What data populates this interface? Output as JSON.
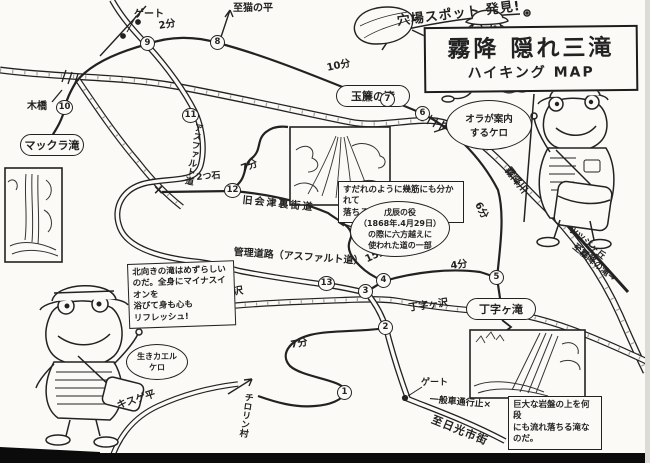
{
  "colors": {
    "ink": "#222222",
    "paper": "#fbfaf7",
    "bottom_bar": "#0b0b0b"
  },
  "title": {
    "banner": "穴場スポット 発見!",
    "main": "霧降 隠れ三滝",
    "sub": "ハイキング MAP"
  },
  "falls": {
    "makkura": "マックラ滝",
    "tamasudare": "玉簾の滝",
    "choji": "丁字ヶ滝"
  },
  "stations": [
    "1",
    "2",
    "3",
    "4",
    "5",
    "6",
    "7",
    "8",
    "9",
    "10",
    "11",
    "12",
    "13"
  ],
  "labels": {
    "gate_top": "ゲート",
    "min2_top": "2分",
    "to_nekonodaira": "至猫の平",
    "min10": "10分",
    "wood_bridge_left": "木橋",
    "wood_bridge_right": "木橋",
    "asphalt_road": "アスファルト道",
    "two_stones": "2つ石",
    "min7_upper": "7分",
    "old_aizu_road": "旧会津裏街道",
    "closed_x": "×",
    "kanri_road": "管理道路（アスファルト道）",
    "choji_sawa_left": "丁字ヶ沢",
    "choji_sawa_right": "丁字ヶ沢",
    "min15": "15分",
    "min4": "4分",
    "min6": "6分",
    "min7_lower": "7分",
    "kirifuri_river": "霧降川",
    "tsutsujigaoka": "ツツジヶ丘",
    "to_kirifuri_falls": "至霧降の滝→",
    "gate_bottom": "ゲート",
    "no_cars": "一般車通行止×",
    "to_nikko_city": "至日光市街",
    "kisuge_daira": "キスゲ平",
    "chirorin_mura": "チロリン村"
  },
  "notes": {
    "guide_bubble": "オラが案内\nするケロ",
    "boshin_note": "戊辰の役\n（1868年.4月29日）\nの際に六方越えに\n使われた道の一部",
    "tamasudare_caption": "すだれのように幾筋にも分かれて\n落ちる滝だ。",
    "choji_caption": "巨大な岩盤の上を何段\nにも流れ落ちる滝なのだ。",
    "makkura_sign": "北向きの滝はめずらしい\nのだ。全身にマイナスイオンを\n浴びて身も心も\nリフレッシュ!",
    "ikikaeru_bubble": "生きカエル\nケロ"
  }
}
